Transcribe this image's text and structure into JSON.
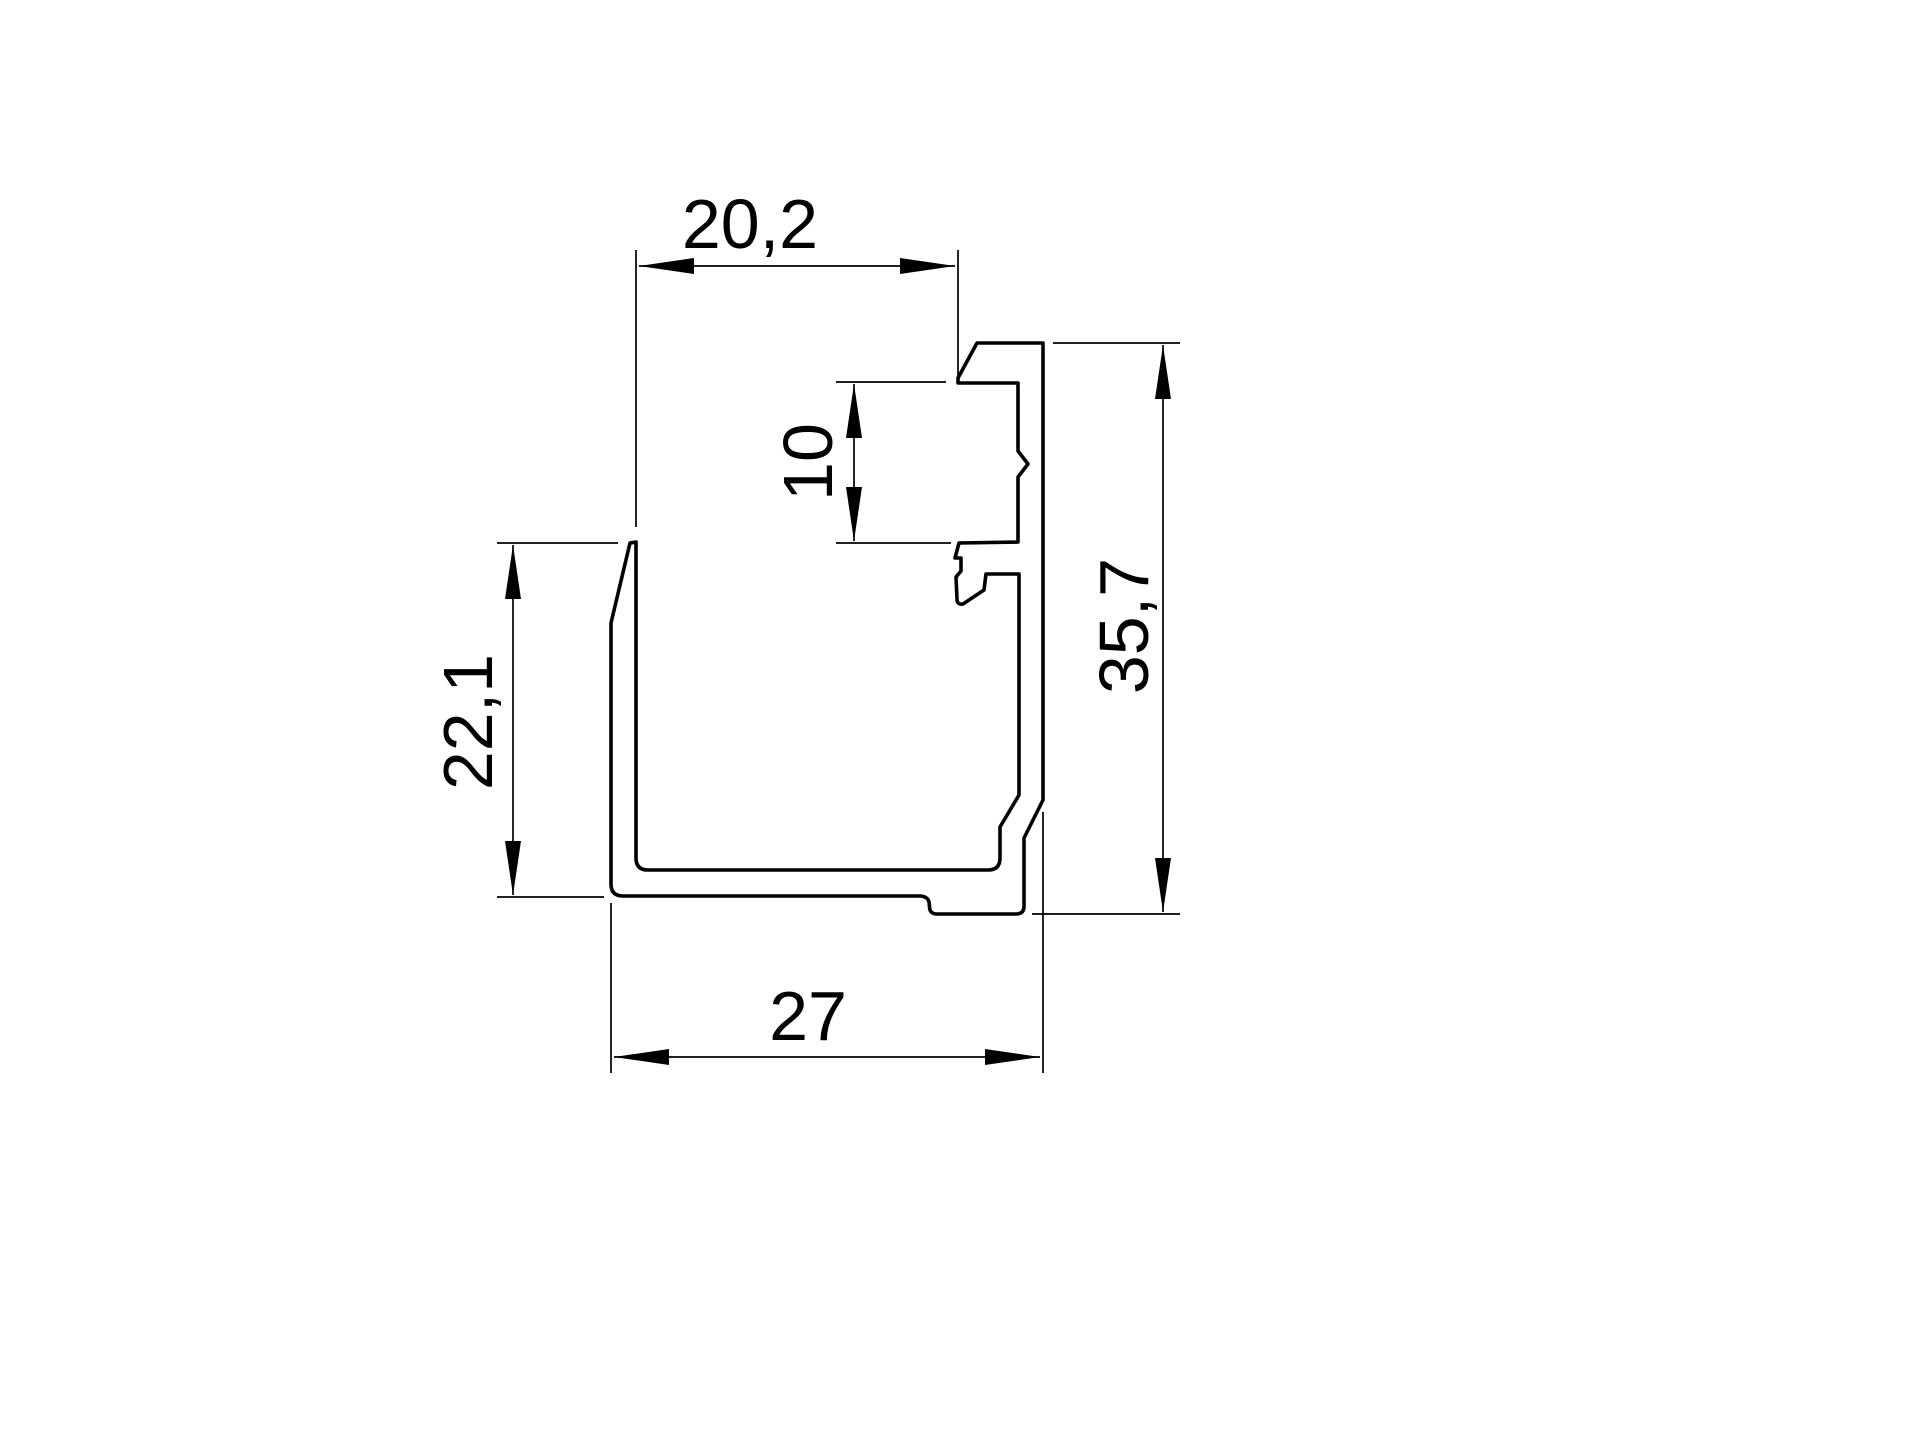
{
  "drawing": {
    "type": "technical-drawing",
    "subject": "aluminium-profile-cross-section",
    "background_color": "#ffffff",
    "line_color": "#000000",
    "unit": "mm",
    "dimensions": [
      {
        "id": "top-inner-width",
        "label": "20,2",
        "value": 20.2,
        "orientation": "horizontal"
      },
      {
        "id": "notch-depth",
        "label": "10",
        "value": 10,
        "orientation": "vertical"
      },
      {
        "id": "overall-height",
        "label": "35,7",
        "value": 35.7,
        "orientation": "vertical"
      },
      {
        "id": "left-wall-height",
        "label": "22,1",
        "value": 22.1,
        "orientation": "vertical"
      },
      {
        "id": "bottom-width",
        "label": "27",
        "value": 27,
        "orientation": "horizontal"
      }
    ]
  }
}
